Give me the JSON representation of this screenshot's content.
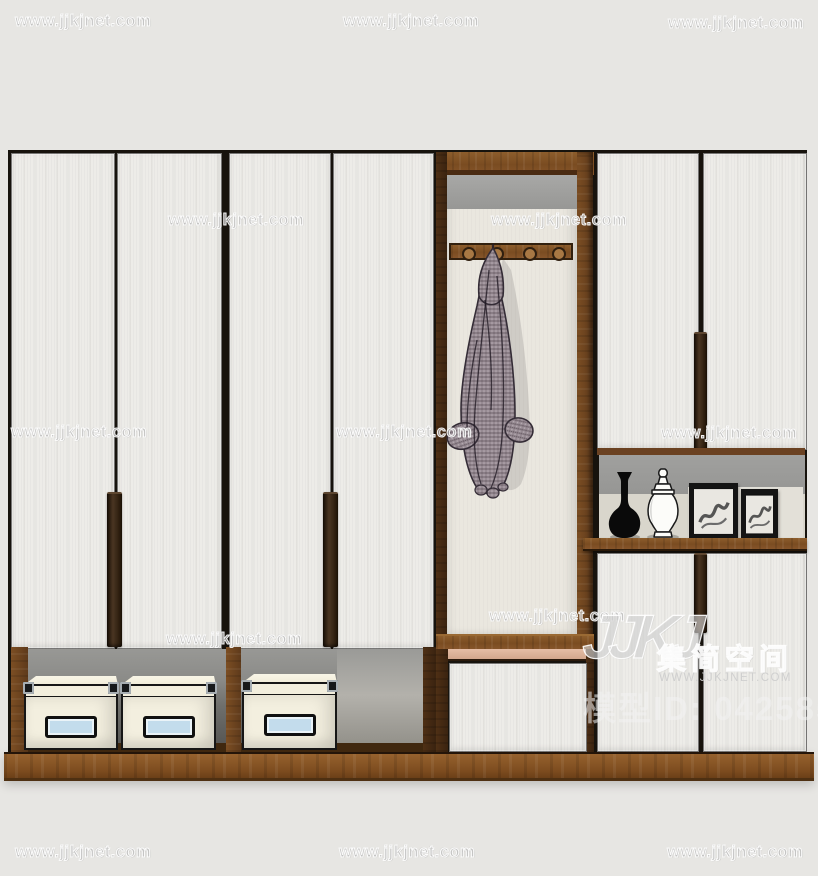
{
  "title": "wardrobe-3d-render",
  "watermark": {
    "text": "www.jjkjnet.com",
    "positions": [
      [
        15,
        12
      ],
      [
        343,
        12
      ],
      [
        668,
        14
      ],
      [
        168,
        211
      ],
      [
        491,
        211
      ],
      [
        11,
        423
      ],
      [
        336,
        423
      ],
      [
        661,
        424
      ],
      [
        489,
        607
      ],
      [
        166,
        630
      ],
      [
        15,
        843
      ],
      [
        339,
        843
      ],
      [
        667,
        843
      ]
    ]
  },
  "logo": {
    "glyph": "JJKJ",
    "brand": "集简空间",
    "url": "WWW.JJKJNET.COM",
    "model_id": "模型ID: 042585"
  },
  "colors": {
    "background": "#e7e6e3",
    "door": "#edece8",
    "outline": "#17130d",
    "wood": "#815126",
    "wood_dark": "#5a3718",
    "wood_base": "#8a5827",
    "gray_band": "#9d9d9b",
    "niche_back": "#eae7df",
    "niche_lower": "#d9d6cc",
    "label_blue": "#c3dcec",
    "box": "#f3efdf",
    "coat": "#94888f",
    "pink_trim": "#ddb39a"
  }
}
